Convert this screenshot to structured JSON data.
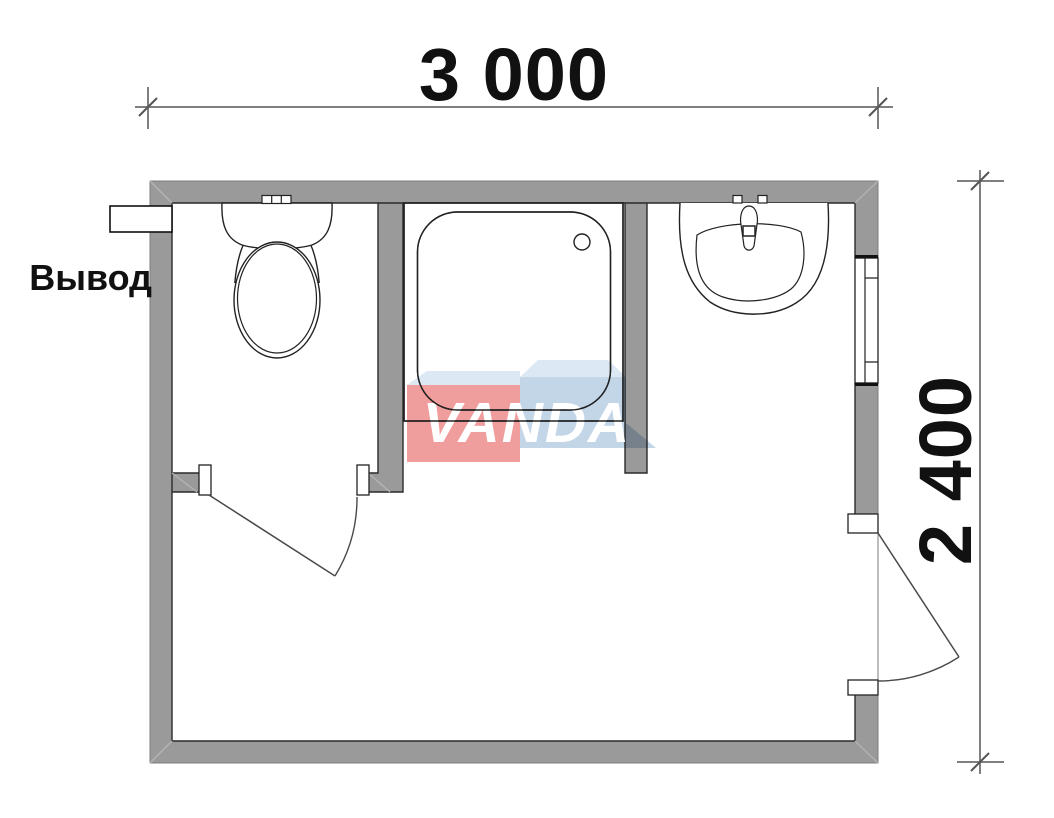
{
  "plan": {
    "title": "bathroom-floor-plan",
    "room_width_mm": "3 000",
    "room_height_mm": "2 400",
    "outlet_label": "Вывод",
    "fixtures": [
      "toilet",
      "shower-tray",
      "washbasin",
      "window",
      "wc-door",
      "entrance-door",
      "water-outlet"
    ],
    "colors": {
      "wall": "#9a9a9a",
      "outline": "#222222",
      "outer_edge": "#7d7d7d",
      "miter": "#b3b3b3",
      "door": "#4a4a4a",
      "dimension": "#7f7f7f",
      "tick": "#555555",
      "background": "#ffffff"
    }
  },
  "watermark": {
    "text": "VANDA",
    "text_color": "#ffffff",
    "pink": "#f09d9d",
    "blue": "#c3d6e8",
    "bevel": "#dce8f3"
  }
}
